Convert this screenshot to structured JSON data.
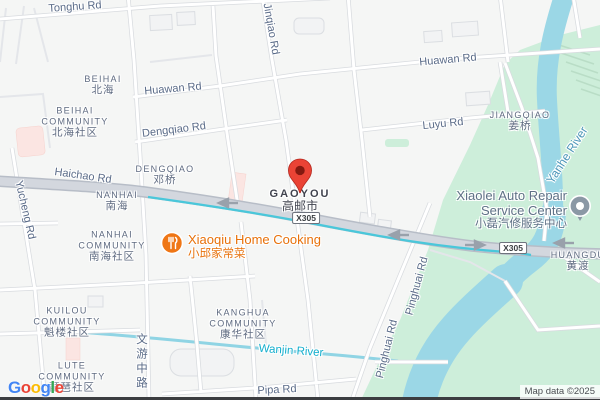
{
  "attribution": {
    "logo": "Google",
    "letters": [
      "G",
      "o",
      "o",
      "g",
      "l",
      "e"
    ],
    "letter_colors": [
      "#4285F4",
      "#EA4335",
      "#FBBC05",
      "#4285F4",
      "#34A853",
      "#EA4335"
    ],
    "map_data": "Map data ©2025"
  },
  "route_badge": "X305",
  "marker": {
    "title": "GAOYOU",
    "subtitle": "高邮市"
  },
  "roads": {
    "tonghu": "Tonghu Rd",
    "jinqiao": "Jinqiao Rd",
    "huawan_west": "Huawan Rd",
    "huawan_east": "Huawan Rd",
    "dengqiao": "Dengqiao Rd",
    "luyu": "Luyu Rd",
    "haichao": "Haichao Rd",
    "yucheng": "Yucheng Rd",
    "wenyou_middle": "文游中路",
    "pipa": "Pipa Rd",
    "pinghuai_a": "Pinghuai Rd",
    "pinghuai_b": "Pinghuai Rd"
  },
  "waters": {
    "yanhe": "Yanhe River",
    "wanjin": "Wanjin River"
  },
  "areas": {
    "beihai": {
      "en": "BEIHAI",
      "zh": "北海"
    },
    "beihai_community": {
      "en1": "BEIHAI",
      "en2": "COMMUNITY",
      "zh": "北海社区"
    },
    "dengqiao": {
      "en": "DENGQIAO",
      "zh": "邓桥"
    },
    "nanhai": {
      "en": "NANHAI",
      "zh": "南海"
    },
    "nanhai_community": {
      "en1": "NANHAI",
      "en2": "COMMUNITY",
      "zh": "南海社区"
    },
    "jiangqiao": {
      "en": "JIANGQIAO",
      "zh": "姜桥"
    },
    "kuilou_community": {
      "en1": "KUILOU",
      "en2": "COMMUNITY",
      "zh": "魁楼社区"
    },
    "kanghua_community": {
      "en1": "KANGHUA",
      "en2": "COMMUNITY",
      "zh": "康华社区"
    },
    "lute_community": {
      "en1": "LUTE",
      "en2": "COMMUNITY",
      "zh": "琵琶社区"
    },
    "huangdu": {
      "en": "HUANGDU",
      "zh": "黄渡"
    }
  },
  "pois": {
    "xiaoqiu": {
      "name": "Xiaoqiu Home Cooking",
      "zh": "小邱家常菜",
      "icon": "restaurant-icon",
      "color": "#ef7615"
    },
    "xiaolei": {
      "line1": "Xiaolei Auto Repair",
      "line2": "Service Center",
      "zh": "小磊汽修服务中心",
      "icon": "place-pin-icon",
      "color": "#8b98a5"
    }
  },
  "colors": {
    "land": "#f5f6f5",
    "park_green": "#cdeeda",
    "water": "#9bd7e6",
    "canal": "#4ac7da",
    "highway_fill": "#d3d7de",
    "highway_casing": "#b7bdc7",
    "marker_red": "#EA4335",
    "poi_orange": "#e8710a"
  }
}
